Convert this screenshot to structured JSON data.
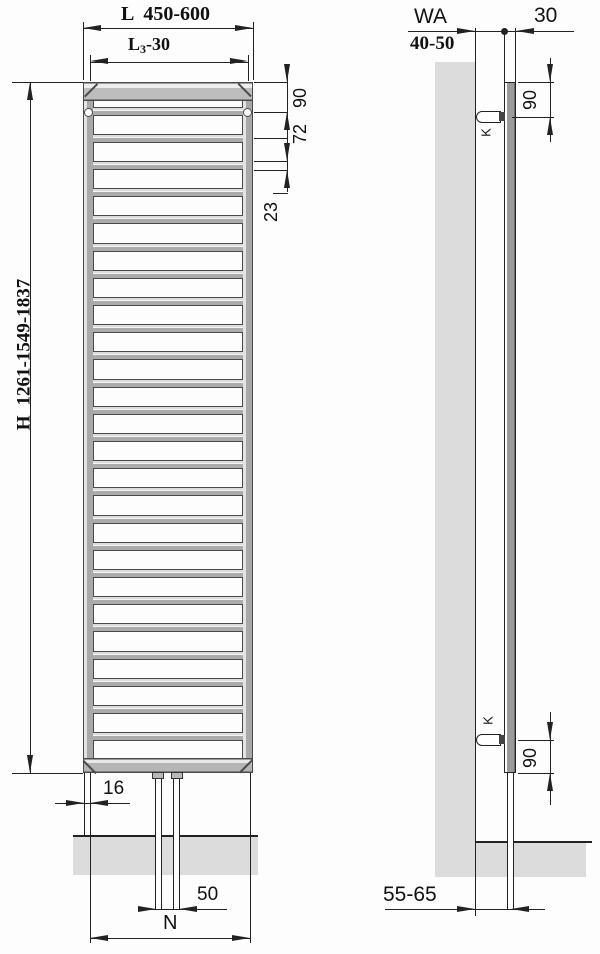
{
  "drawing": {
    "front_view": {
      "bar_count": 24,
      "dims": {
        "overall_width_prefix": "L",
        "overall_width": "450-600",
        "inner_width_prefix": "L",
        "inner_width_sub": "3",
        "inner_width": "-30",
        "height_prefix": "H",
        "height": "1261-1549-1837",
        "top_to_hanger": "90",
        "hanger_to_bar": "72",
        "bar_size": "23",
        "edge_offset": "16",
        "pipe_spacing": "50",
        "connection_width": "N"
      }
    },
    "side_view": {
      "dims": {
        "wall_distance_label": "WA",
        "wall_distance": "40-50",
        "depth": "30",
        "top_hanger": "90",
        "bottom_hanger": "90",
        "wall_to_pipe": "55-65"
      },
      "bracket_top": "K",
      "bracket_bottom": "K"
    }
  }
}
